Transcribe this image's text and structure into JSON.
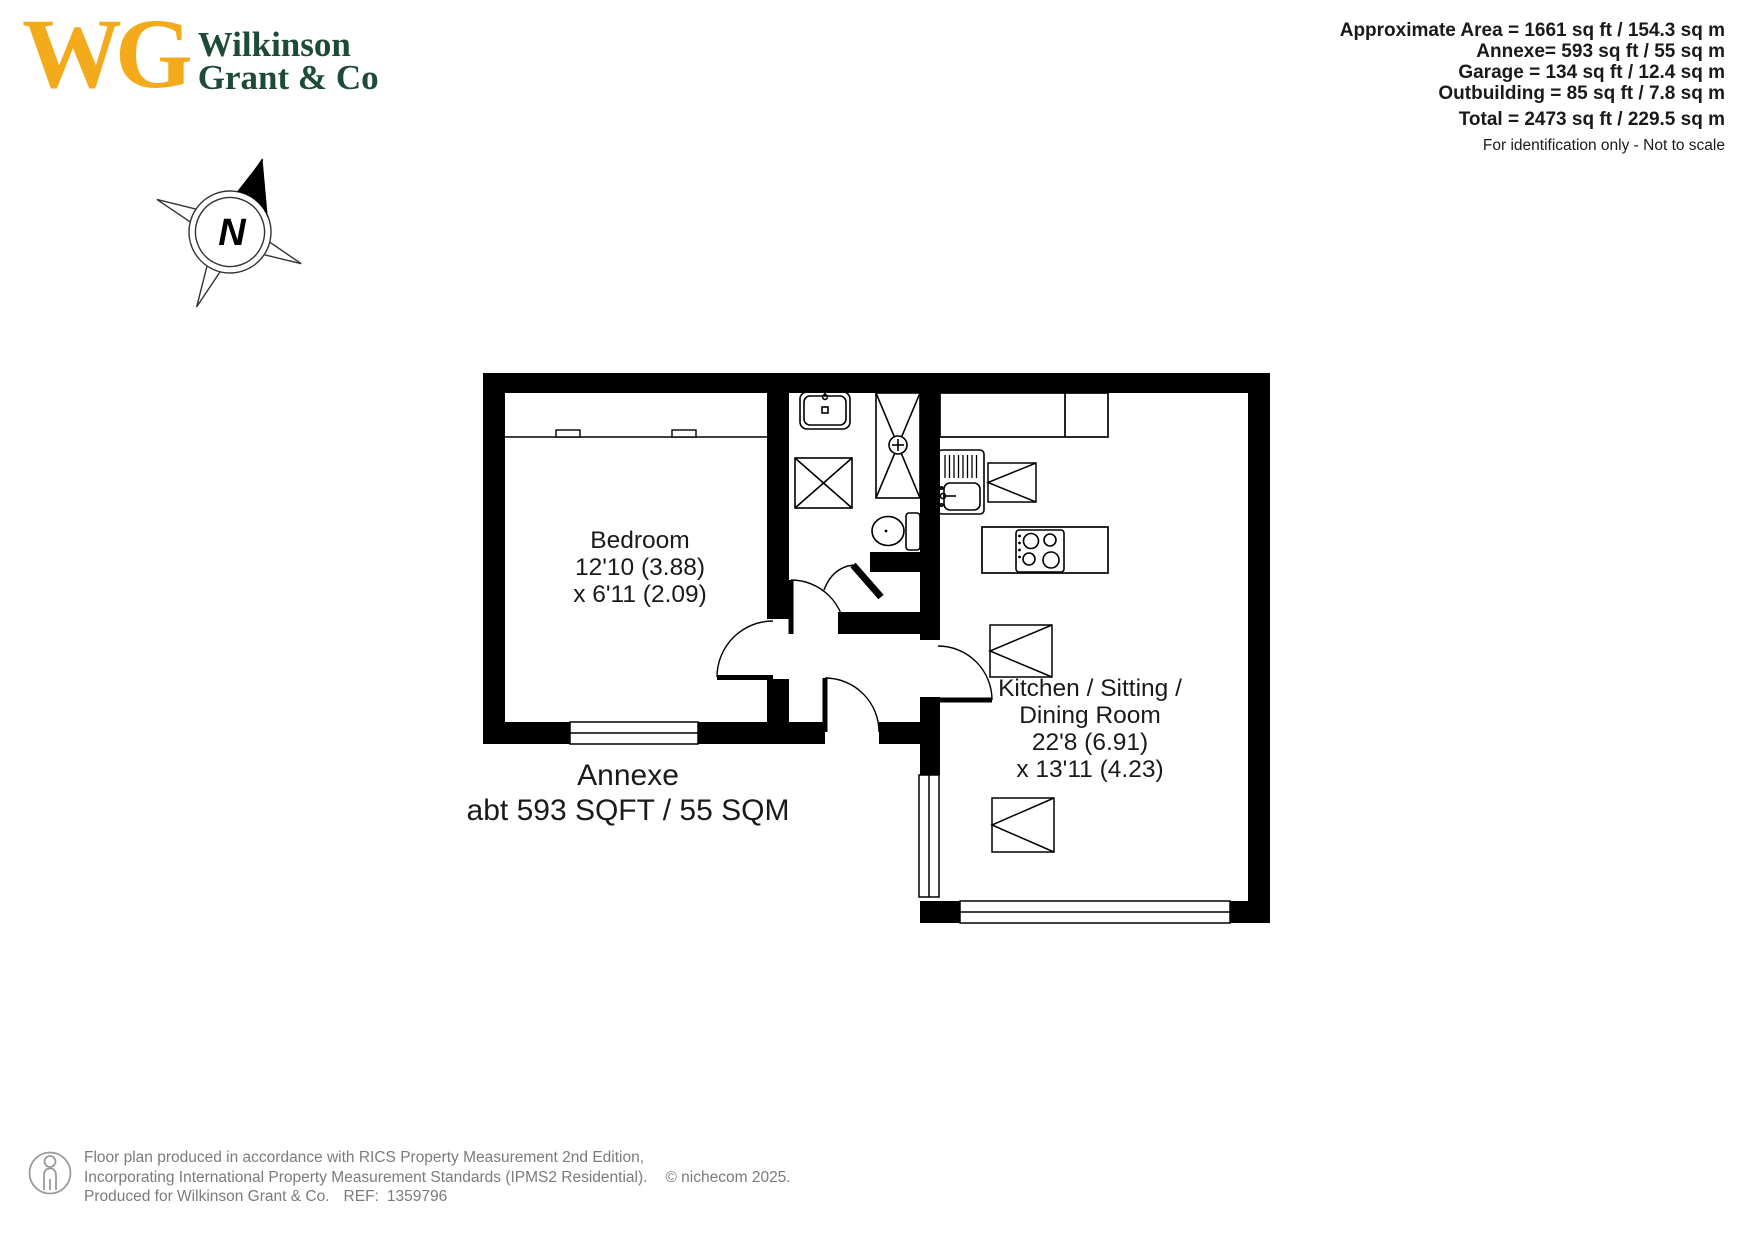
{
  "logo": {
    "monogram": "WG",
    "name_line1": "Wilkinson",
    "name_line2": "Grant & Co"
  },
  "area_summary": {
    "lines": [
      "Approximate Area = 1661 sq ft / 154.3 sq m",
      "Annexe= 593 sq ft / 55 sq m",
      "Garage = 134 sq ft / 12.4 sq m",
      "Outbuilding = 85 sq ft / 7.8 sq m"
    ],
    "total": "Total = 2473 sq ft / 229.5 sq m",
    "note": "For identification only - Not to scale"
  },
  "compass": {
    "north_label": "N"
  },
  "plan": {
    "bedroom": {
      "name": "Bedroom",
      "dim1": "12'10 (3.88)",
      "dim2": "x 6'11 (2.09)"
    },
    "kitchen": {
      "name_line1": "Kitchen / Sitting /",
      "name_line2": "Dining Room",
      "dim1": "22'8 (6.91)",
      "dim2": "x 13'11 (4.23)"
    },
    "annexe_line1": "Annexe",
    "annexe_line2": "abt 593 SQFT / 55 SQM"
  },
  "footer": {
    "line1": "Floor plan produced in accordance with RICS Property Measurement 2nd Edition,",
    "line2": "Incorporating International Property Measurement Standards (IPMS2 Residential).",
    "credit": "© nichecom  2025.",
    "line3": "Produced for Wilkinson Grant & Co.",
    "ref_label": "REF:",
    "ref_number": "1359796"
  },
  "colors": {
    "brand_yellow": "#F4AB1B",
    "brand_green": "#1E4B37",
    "plan_line": "#000000",
    "muted_text": "#7B7B7B"
  }
}
